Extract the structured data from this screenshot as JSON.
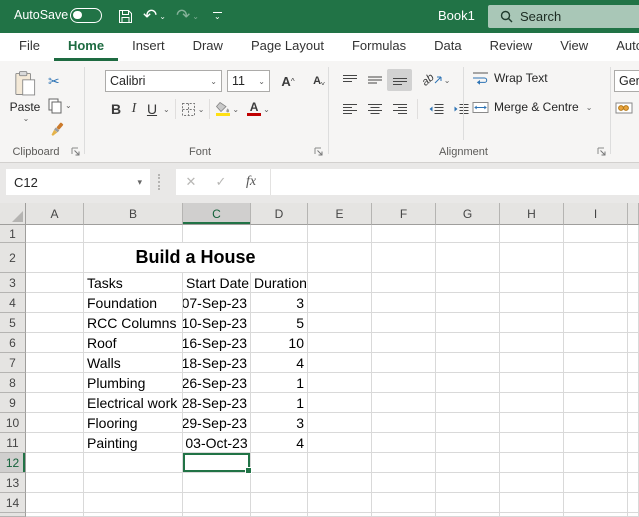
{
  "titlebar": {
    "autosave_label": "AutoSave",
    "document_title": "Book1",
    "search_label": "Search"
  },
  "icons": {
    "undo": "↶",
    "redo": "↷",
    "scissors": "✂",
    "chevron_down": "⌄",
    "dropdown": "▾",
    "cancel": "✕",
    "enter": "✓",
    "fx": "fx",
    "orientation_letters": "ab"
  },
  "tabs": [
    {
      "label": "File",
      "active": false
    },
    {
      "label": "Home",
      "active": true
    },
    {
      "label": "Insert",
      "active": false
    },
    {
      "label": "Draw",
      "active": false
    },
    {
      "label": "Page Layout",
      "active": false
    },
    {
      "label": "Formulas",
      "active": false
    },
    {
      "label": "Data",
      "active": false
    },
    {
      "label": "Review",
      "active": false
    },
    {
      "label": "View",
      "active": false
    },
    {
      "label": "Automate",
      "active": false
    }
  ],
  "ribbon": {
    "clipboard": {
      "label": "Clipboard",
      "paste_label": "Paste"
    },
    "font": {
      "label": "Font",
      "font_name": "Calibri",
      "font_size": "11",
      "bold": "B",
      "italic": "I",
      "underline": "U",
      "grow_letter": "A",
      "shrink_letter": "A",
      "font_color_letter": "A"
    },
    "alignment": {
      "label": "Alignment",
      "wrap_text": "Wrap Text",
      "merge_centre": "Merge & Centre"
    },
    "number": {
      "value": "Gen"
    }
  },
  "formula_bar": {
    "name_box": "C12",
    "formula": ""
  },
  "sheet": {
    "col_headers": [
      "A",
      "B",
      "C",
      "D",
      "E",
      "F",
      "G",
      "H",
      "I",
      ""
    ],
    "row_numbers": [
      "1",
      "2",
      "3",
      "4",
      "5",
      "6",
      "7",
      "8",
      "9",
      "10",
      "11",
      "12",
      "13",
      "14"
    ],
    "selected_col": "C",
    "selected_row": 12,
    "selected_cell_ref": "C12",
    "title": {
      "text": "Build a House",
      "row": 2
    },
    "header_row": {
      "row": 3,
      "cells": [
        "Tasks",
        "Start Date",
        "Duration"
      ]
    },
    "tasks": [
      {
        "row": 4,
        "task": "Foundation",
        "start": "07-Sep-23",
        "duration": "3"
      },
      {
        "row": 5,
        "task": "RCC Columns",
        "start": "10-Sep-23",
        "duration": "5"
      },
      {
        "row": 6,
        "task": "Roof",
        "start": "16-Sep-23",
        "duration": "10"
      },
      {
        "row": 7,
        "task": "Walls",
        "start": "18-Sep-23",
        "duration": "4"
      },
      {
        "row": 8,
        "task": "Plumbing",
        "start": "26-Sep-23",
        "duration": "1"
      },
      {
        "row": 9,
        "task": "Electrical work",
        "start": "28-Sep-23",
        "duration": "1"
      },
      {
        "row": 10,
        "task": "Flooring",
        "start": "29-Sep-23",
        "duration": "3"
      },
      {
        "row": 11,
        "task": "Painting",
        "start": "03-Oct-23",
        "duration": "4",
        "start_align": "center"
      }
    ]
  },
  "colors": {
    "titlebar_green": "#217346",
    "accent_green": "#1e6b41",
    "selection_green": "#217346",
    "search_bg": "#a9c7b7",
    "fill_yellow": "#ffe013",
    "font_red": "#c00000",
    "icon_blue": "#2e74b5",
    "brush_orange": "#cb7a2b"
  }
}
